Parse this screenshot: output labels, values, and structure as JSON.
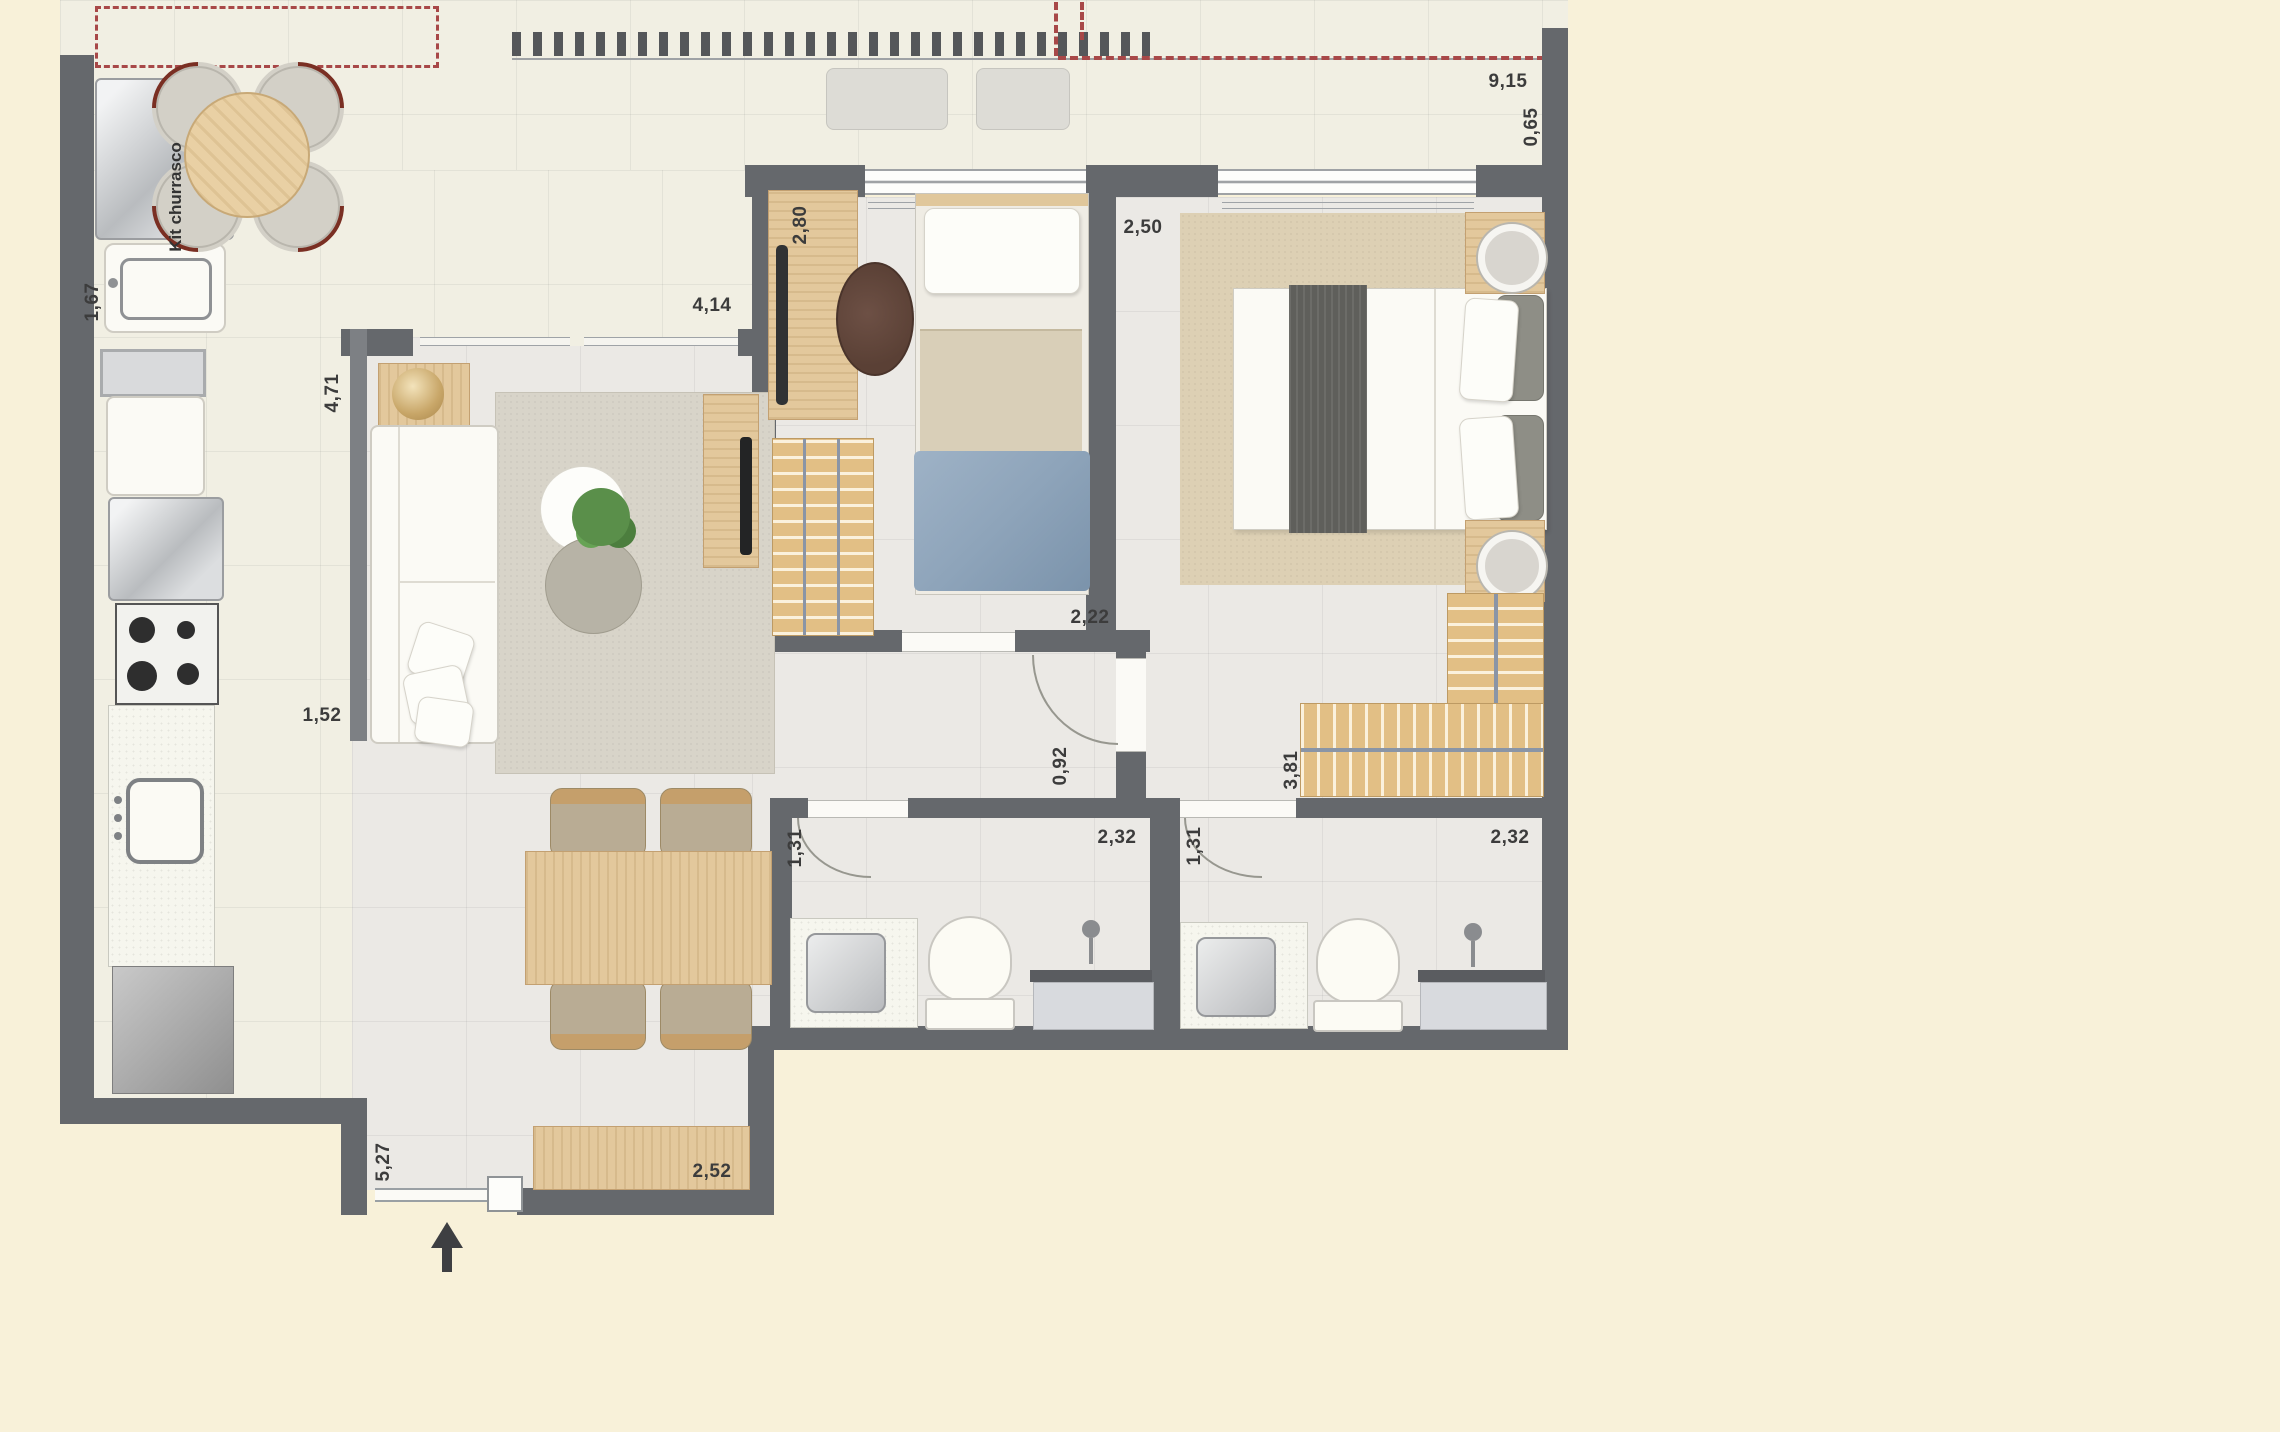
{
  "meta": {
    "type": "apartment-floor-plan",
    "canvas": {
      "width": 2280,
      "height": 1432
    }
  },
  "colors": {
    "background": "#f8f1d9",
    "wall": "#65686c",
    "floor_pale": "#f1efe3",
    "floor_gray": "#ebe9e5",
    "wood": "#e3c89c",
    "red_dashed_projection": "#a84848",
    "rug_living": "#d8d4c9",
    "rug_master": "#ddd0b4",
    "blanket_blue": "#8ea4ba",
    "blanket_gray": "#5f5f5b",
    "label_text": "#3c3c3c"
  },
  "labels": {
    "kit_churrasco": "Kit churrasco"
  },
  "dims": {
    "total_width": "9,15",
    "balcony_depth": "0,65",
    "grill_width": "1,67",
    "living_length": "4,71",
    "living_width": "4,14",
    "bedroom2_length": "2,80",
    "bedroom1_width": "2,50",
    "living_width2": "1,52",
    "bedroom2_width": "2,22",
    "hall_width": "0,92",
    "wardrobe_length": "3,81",
    "bath1_width": "1,31",
    "bath1_length": "2,32",
    "bath2_width": "1,31",
    "bath2_length": "2,32",
    "dining_length": "5,27",
    "sideboard_length": "2,52"
  }
}
